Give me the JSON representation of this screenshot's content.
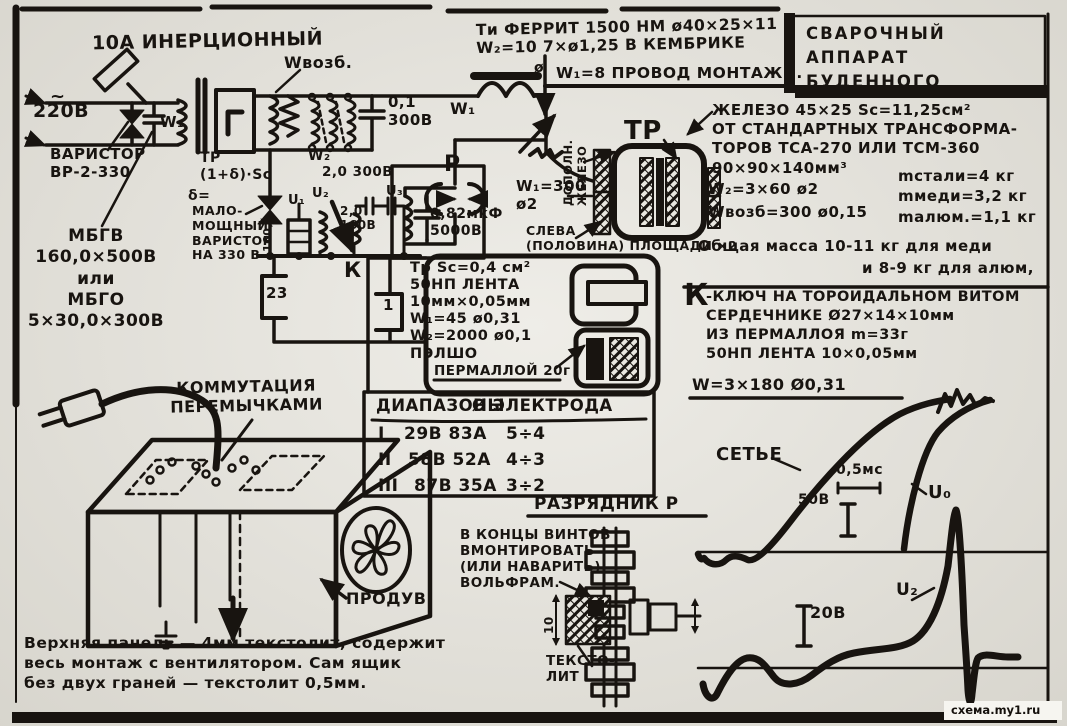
{
  "title": "СВАРОЧНЫЙ\nАППАРАТ\nБУДЕННОГО",
  "watermark": "схема.my1.ru",
  "labels": {
    "fuse": "10А ИНЕРЦИОННЫЙ",
    "tilde": "~",
    "mains": "220В",
    "varistor": "ВАРИСТОР\nВР-2-330",
    "mbgv": "МБГВ\n160,0×500В\nили\nМБГО\n5×30,0×300В",
    "w1": "W₁",
    "trcore": "ТР\n(1+δ)·Sc",
    "delta": "δ=",
    "malomosch": "МАЛО-\nМОЩНЫЙ\nВАРИСТОР\nНА 330 В",
    "wvozb": "Wвозб.",
    "cap01": "0,1\n300В",
    "w2": "W₂",
    "cap20": "2,0 300В",
    "u1": "U₁",
    "u2": "U₂",
    "u3": "U₃",
    "cap20160": "2,0\n160В",
    "r160": "160,0",
    "k": "К",
    "t23": "23",
    "t1": "1",
    "p": "Р",
    "cap082": "0,82мкФ\n5000В",
    "ti": "Ти ФЕРРИТ 1500 НМ ø40×25×11\nW₂=10  7×ø1,25 В КЕМБРИКЕ",
    "ti2": "W₁=8 ПРОВОД МОНТАЖН.",
    "w1t": "W₁",
    "phi": "ø",
    "dopoln": "ДОПОЛН.\nЖЕЛЕЗО",
    "trbig": "ТР",
    "w1300": "W₁=300\nø2",
    "sleva": "СЛЕВА\n(ПОЛОВИНА) ПЛОЩАДИ ×2",
    "zhelezo": "ЖЕЛЕЗО 45×25  Sc=11,25см²\nОТ СТАНДАРТНЫХ ТРАНСФОРМА-\nТОРОВ ТСА-270 ИЛИ ТСМ-360\n90×90×140мм³",
    "w260": "W₂=3×60 ø2",
    "wvozb300": "Wвозб=300 ø0,15",
    "masses": "mстали=4 кг\nmмеди=3,2 кг\nmалюм.=1,1 кг",
    "obshch": "Общая масса 10-11 кг для меди",
    "obshch2": "и 8-9 кг для алюм,",
    "trspec": "Тр Sc=0,4 см²\n50НП ЛЕНТА\n10мм×0,05мм\nW₁=45 ø0,31\nW₂=2000 ø0,1\nПЭЛШО",
    "permalloy": "ПЕРМАЛЛОЙ 20г",
    "kbig": "К",
    "ktext": "-КЛЮЧ НА ТОРОИДАЛЬНОМ ВИТОМ\nСЕРДЕЧНИКЕ Ø27×14×10мм\nИЗ ПЕРМАЛЛОЯ m=33г\n50НП ЛЕНТА 10×0,05мм",
    "w3180": "W=3×180 Ø0,31",
    "kommut": "КОММУТАЦИЯ\nПЕРЕМЫЧКАМИ",
    "produv": "ПРОДУВ",
    "panel": "Верхняя панель — 4мм текстолит, содержит\nвесь монтаж с вентилятором. Сам ящик\nбез двух граней — текстолит 0,5мм.",
    "razr": "РАЗРЯДНИК Р",
    "vintov": "В КОНЦЫ ВИНТОВ\nВМОНТИРОВАТЬ\n(ИЛИ НАВАРИТЬ)\nВОЛЬФРАМ.",
    "tekstolit": "ТЕКСТО-\nЛИТ",
    "dim10": "10",
    "set": "СЕТЬЕ",
    "ms": "0,5мс",
    "v50": "50В",
    "u0": "U₀",
    "v20": "20В",
    "u2w": "U₂"
  },
  "table": {
    "headers": [
      "ДИАПАЗОНЫ",
      "Ø ЭЛЕКТРОДА"
    ],
    "rows": [
      [
        "I",
        "29В 83А",
        "5÷4"
      ],
      [
        "II",
        "58В 52А",
        "4÷3"
      ],
      [
        "III",
        "87В 35А",
        "3÷2"
      ]
    ]
  },
  "colors": {
    "ink": "#181410",
    "paper": "#e9e7e0"
  }
}
